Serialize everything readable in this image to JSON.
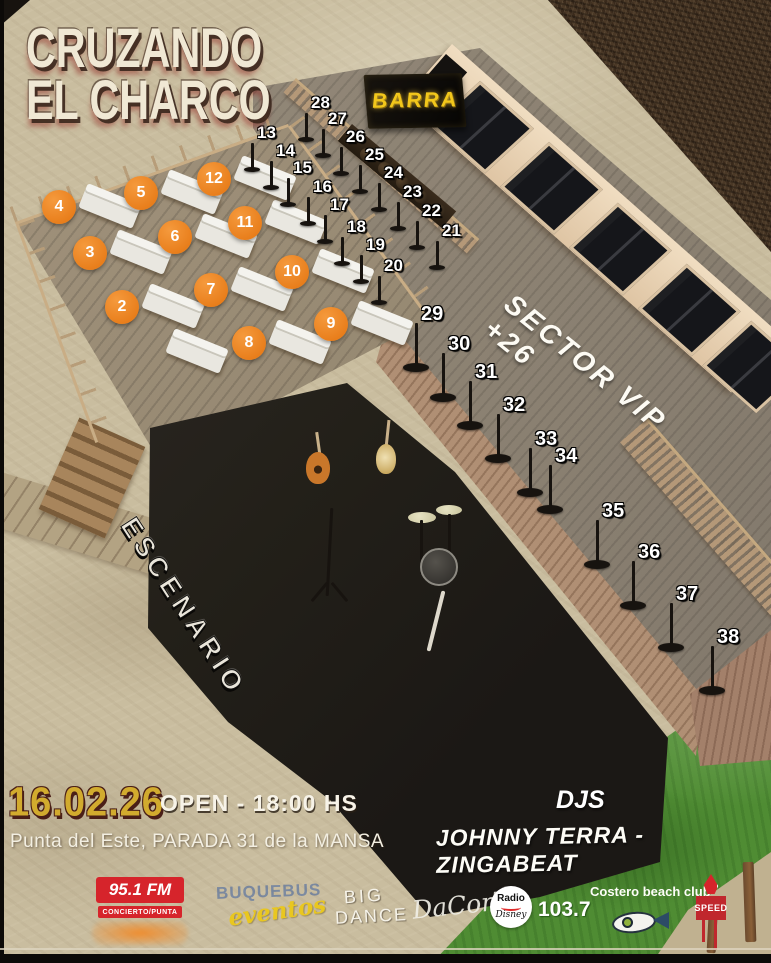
{
  "event": {
    "title_line1": "CRUZANDO",
    "title_line2": "EL CHARCO",
    "date": "16.02.26",
    "open_time": "OPEN - 18:00 HS",
    "venue": "Punta del Este, PARADA 31 de la MANSA",
    "djs_label": "DJS",
    "djs_names": "JOHNNY TERRA - ZINGABEAT"
  },
  "map": {
    "bar_label": "BARRA",
    "vip_label": "SECTOR VIP +26",
    "stage_label": "ESCENARIO",
    "lounge_tables": [
      "2",
      "3",
      "4",
      "5",
      "6",
      "7",
      "8",
      "9",
      "10",
      "11",
      "12"
    ],
    "upper_row_tables": [
      "13",
      "14",
      "15",
      "16",
      "17",
      "18",
      "19",
      "20"
    ],
    "bar_row_tables": [
      "28",
      "27",
      "26",
      "25",
      "24",
      "23",
      "22",
      "21"
    ],
    "vip_row_tables": [
      "29",
      "30",
      "31",
      "32",
      "33",
      "34",
      "35",
      "36",
      "37",
      "38"
    ]
  },
  "sponsors": {
    "radio_fm": "95.1 FM",
    "radio_fm_sub": "CONCIERTO/PUNTA",
    "buquebus": "BUQUEBUS",
    "buquebus_sub": "eventos",
    "big_dance_line1": "BIG",
    "big_dance_line2": "DANCE",
    "dacorte": "DaCorTe",
    "radio_disney_line1": "Radio",
    "radio_disney_line2": "Disney",
    "radio_disney_freq": "103.7",
    "costero": "Costero beach club",
    "speed": "SPEED"
  },
  "colors": {
    "accent_orange": "#E87D1A",
    "title_cream": "#F0E8D4",
    "date_gold": "#D2AB2E",
    "bar_yellow": "#F2C71B",
    "stage_black": "#211E1C",
    "grass_green": "#4F8C33",
    "sand": "#C9BD9F",
    "sponsor_red": "#D6242B",
    "buquebus_blue": "#3A6AB0"
  }
}
